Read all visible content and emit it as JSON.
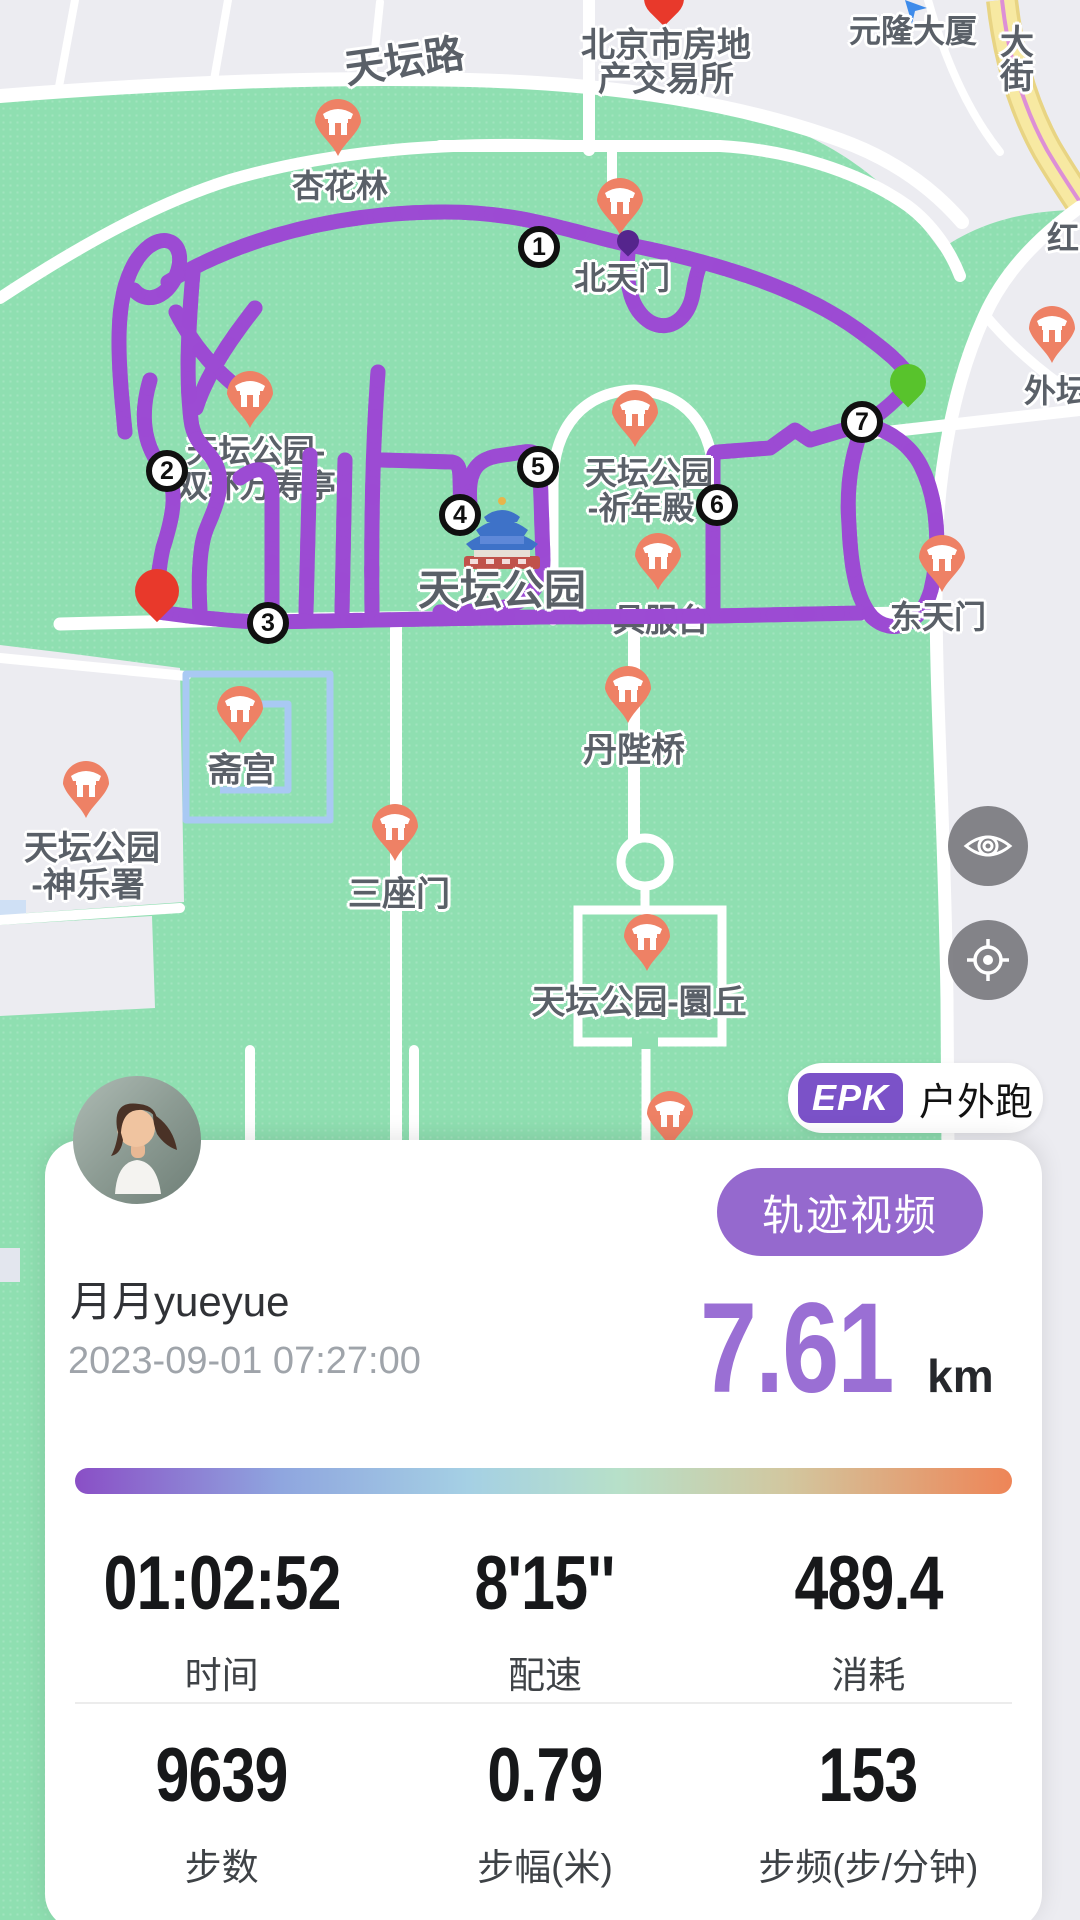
{
  "map": {
    "labels": [
      {
        "text": "天坛路",
        "x": 404,
        "y": 58,
        "size": 40,
        "rotate": -8,
        "layer": "over"
      },
      {
        "text": "北京市房地",
        "x": 666,
        "y": 42,
        "size": 34,
        "layer": "over"
      },
      {
        "text": "产交易所",
        "x": 666,
        "y": 76,
        "size": 34,
        "layer": "over"
      },
      {
        "text": "元隆大厦",
        "x": 913,
        "y": 29,
        "size": 32,
        "layer": "over"
      },
      {
        "text": "大街",
        "x": 1014,
        "y": 58,
        "size": 34,
        "vertical": true,
        "layer": "over"
      },
      {
        "text": "红",
        "x": 1063,
        "y": 236,
        "size": 32,
        "layer": "over"
      },
      {
        "text": "杏花林",
        "x": 340,
        "y": 184,
        "size": 32,
        "layer": "over"
      },
      {
        "text": "北天门",
        "x": 622,
        "y": 276,
        "size": 32,
        "layer": "over"
      },
      {
        "text": "外坛",
        "x": 1056,
        "y": 389,
        "size": 32,
        "layer": "over"
      },
      {
        "text": "天坛公园-",
        "x": 256,
        "y": 449,
        "size": 32,
        "layer": "under"
      },
      {
        "text": "双环万寿亭",
        "x": 256,
        "y": 484,
        "size": 32,
        "layer": "under"
      },
      {
        "text": "天坛公园",
        "x": 649,
        "y": 471,
        "size": 32,
        "layer": "over"
      },
      {
        "text": "-祈年殿",
        "x": 641,
        "y": 506,
        "size": 32,
        "layer": "over"
      },
      {
        "text": "具服台",
        "x": 661,
        "y": 618,
        "size": 32,
        "layer": "under"
      },
      {
        "text": "天坛公园",
        "x": 502,
        "y": 587,
        "size": 42,
        "layer": "over"
      },
      {
        "text": "东天门",
        "x": 938,
        "y": 615,
        "size": 32,
        "layer": "over"
      },
      {
        "text": "斋宫",
        "x": 242,
        "y": 767,
        "size": 34,
        "layer": "over"
      },
      {
        "text": "丹陛桥",
        "x": 634,
        "y": 747,
        "size": 34,
        "layer": "over"
      },
      {
        "text": "天坛公园",
        "x": 92,
        "y": 845,
        "size": 34,
        "layer": "over"
      },
      {
        "text": "-神乐署",
        "x": 88,
        "y": 882,
        "size": 34,
        "layer": "over"
      },
      {
        "text": "三座门",
        "x": 399,
        "y": 891,
        "size": 34,
        "layer": "over"
      },
      {
        "text": "天坛公园-圜丘",
        "x": 639,
        "y": 999,
        "size": 34,
        "layer": "over"
      }
    ],
    "poi_pins": [
      {
        "name": "杏花林",
        "x": 338,
        "y": 158
      },
      {
        "name": "北天门",
        "x": 620,
        "y": 237
      },
      {
        "name": "天坛公园-双环万寿亭",
        "x": 250,
        "y": 430
      },
      {
        "name": "天坛公园-祈年殿",
        "x": 635,
        "y": 449
      },
      {
        "name": "具服台",
        "x": 658,
        "y": 592
      },
      {
        "name": "东天门",
        "x": 942,
        "y": 594
      },
      {
        "name": "斋宫",
        "x": 240,
        "y": 745
      },
      {
        "name": "天坛公园-神乐署",
        "x": 86,
        "y": 820
      },
      {
        "name": "三座门",
        "x": 395,
        "y": 863
      },
      {
        "name": "丹陛桥",
        "x": 628,
        "y": 725
      },
      {
        "name": "天坛公园-圜丘",
        "x": 647,
        "y": 973
      },
      {
        "name": "外坛",
        "x": 1052,
        "y": 365
      },
      {
        "name": "南门",
        "x": 670,
        "y": 1150
      }
    ],
    "waypoints": [
      {
        "n": "1",
        "x": 539,
        "y": 247
      },
      {
        "n": "2",
        "x": 167,
        "y": 471
      },
      {
        "n": "3",
        "x": 268,
        "y": 623
      },
      {
        "n": "4",
        "x": 460,
        "y": 515
      },
      {
        "n": "5",
        "x": 538,
        "y": 467
      },
      {
        "n": "6",
        "x": 717,
        "y": 505
      },
      {
        "n": "7",
        "x": 862,
        "y": 422
      }
    ],
    "start_pin": {
      "name": "finish-pin",
      "x": 157,
      "y": 613,
      "color": "#E8392B"
    },
    "end_pin": {
      "name": "route-end-pin",
      "x": 908,
      "y": 400,
      "color": "#58C32C"
    },
    "km_pin": {
      "name": "km-marker-pin",
      "x": 628,
      "y": 252,
      "color": "#55258D"
    },
    "colors": {
      "park_green": "#8FDFB1",
      "track_purple": "#9C4BD3",
      "track_light": "#C795EC",
      "track_dark": "#6E28A6",
      "gray_area": "#ECECF1",
      "poi_orange": "#EE8165",
      "moat_blue": "#A9C9F3",
      "yellow_road": "#F7E9A2"
    }
  },
  "controls": {
    "eye_button": "eye",
    "locate_button": "locate"
  },
  "badge": {
    "chip": "EPK",
    "activity": "户外跑"
  },
  "card": {
    "user_name": "月月yueyue",
    "datetime": "2023-09-01 07:27:00",
    "video_button_label": "轨迹视频",
    "distance_value": "7.61",
    "distance_unit": "km",
    "stats": [
      {
        "value": "01:02:52",
        "label": "时间"
      },
      {
        "value": "8'15''",
        "label": "配速"
      },
      {
        "value": "489.4",
        "label": "消耗"
      },
      {
        "value": "9639",
        "label": "步数"
      },
      {
        "value": "0.79",
        "label": "步幅(米)"
      },
      {
        "value": "153",
        "label": "步频(步/分钟)"
      }
    ]
  }
}
